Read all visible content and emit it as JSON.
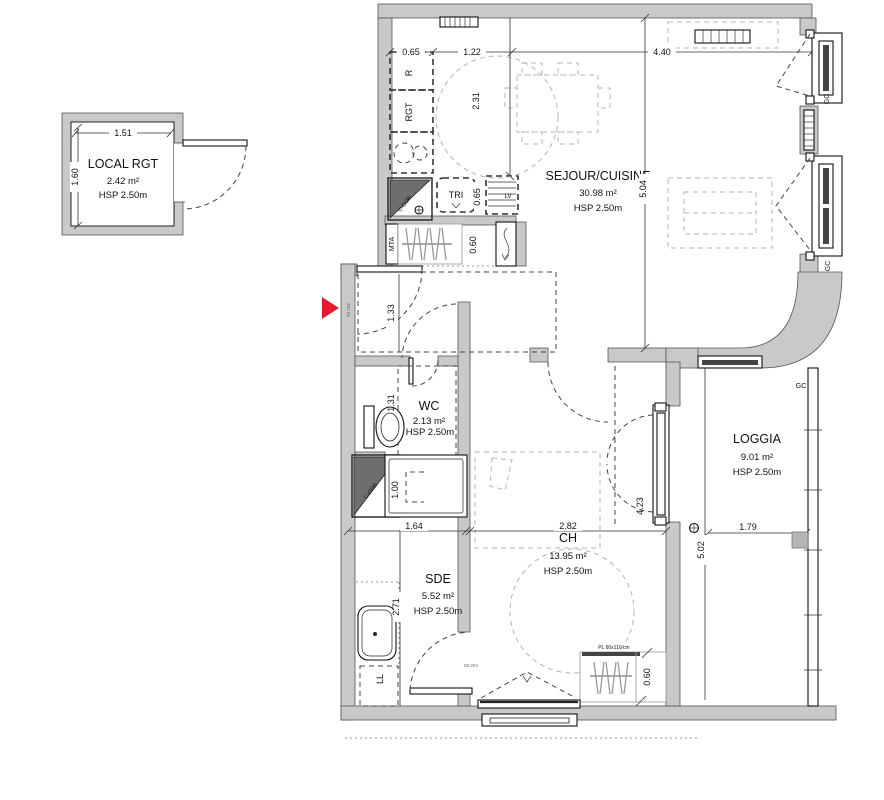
{
  "colors": {
    "wall_gray": "#c9c9c9",
    "dark_fixture_gray": "#6e6e6e",
    "furniture_gray": "#b5b5b5",
    "line_dark": "#222222",
    "entry_arrow_red": "#e8192c"
  },
  "rooms": {
    "local_rgt": {
      "name": "LOCAL RGT",
      "area": "2.42 m²",
      "hsp": "HSP 2.50m"
    },
    "sejour_cuisine": {
      "name": "SEJOUR/CUISINE",
      "area": "30.98 m²",
      "hsp": "HSP 2.50m"
    },
    "wc": {
      "name": "WC",
      "area": "2.13 m²",
      "hsp": "HSP 2.50m"
    },
    "sde": {
      "name": "SDE",
      "area": "5.52 m²",
      "hsp": "HSP 2.50m"
    },
    "ch": {
      "name": "CH",
      "area": "13.95 m²",
      "hsp": "HSP 2.50m"
    },
    "loggia": {
      "name": "LOGGIA",
      "area": "9.01 m²",
      "hsp": "HSP 2.50m"
    }
  },
  "dims": {
    "local_w": "1.51",
    "local_h": "1.60",
    "top_a": "0.65",
    "top_b": "1.22",
    "top_c": "4.40",
    "closet_depth": "2.31",
    "sejour_h": "5.04",
    "hall": "1.33",
    "wc_w": "1.31",
    "counter": "0.65",
    "kitchen_closet": "0.60",
    "sde_w": "1.64",
    "shower": "1.00",
    "sde_h": "2.71",
    "ch_w": "2.82",
    "ch_h": "4.23",
    "loggia_w": "1.79",
    "loggia_h": "5.02",
    "ch_closet": "0.60"
  },
  "tags": {
    "r": "R",
    "rgt": "RGT",
    "tri": "TRI",
    "lv": "LV",
    "mta": "MTA",
    "cgob_kitchen": "C-GOB",
    "cgob_sde": "C-GOB",
    "ll": "LL",
    "gc_win1": "GC",
    "gc_win2": "GC",
    "gc_loggia": "GC",
    "pl_ch": "PL 60x110 cm",
    "door_entry": "93 204",
    "door_ch": "83 204"
  }
}
